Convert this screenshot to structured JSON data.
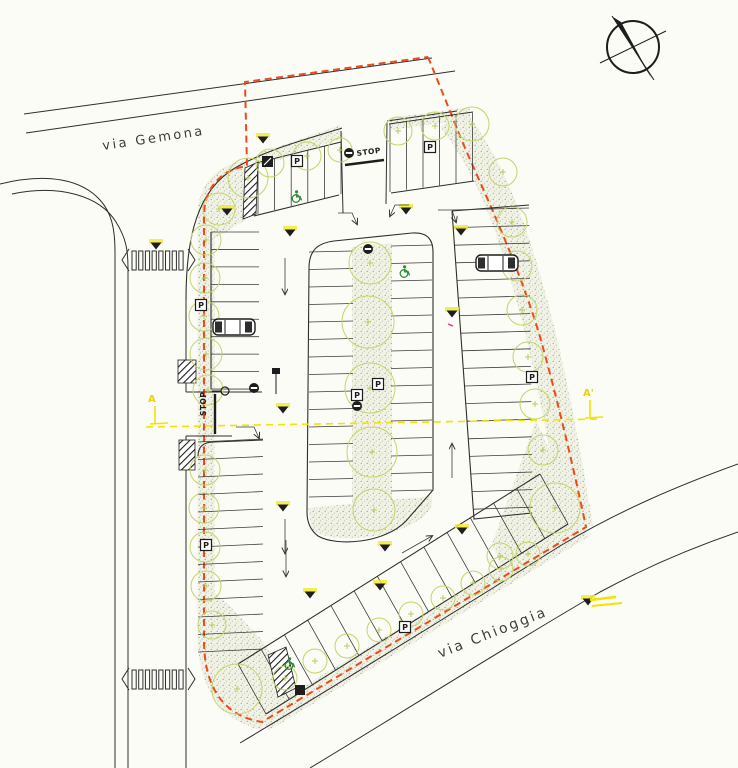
{
  "plan": {
    "streets": {
      "gemona": "via Gemona",
      "chioggia": "via Chioggia"
    },
    "markings": {
      "stop": "STOP",
      "parking": "P"
    },
    "section": {
      "start": "A",
      "end": "A'"
    },
    "colors": {
      "boundary_red": "#ee4a1c",
      "tree_green": "#c3d46a",
      "accessible_green": "#2e8b3a",
      "highlight_yellow": "#f0e400",
      "ink": "#2e2e2e",
      "paper": "#fcfcf7"
    }
  }
}
